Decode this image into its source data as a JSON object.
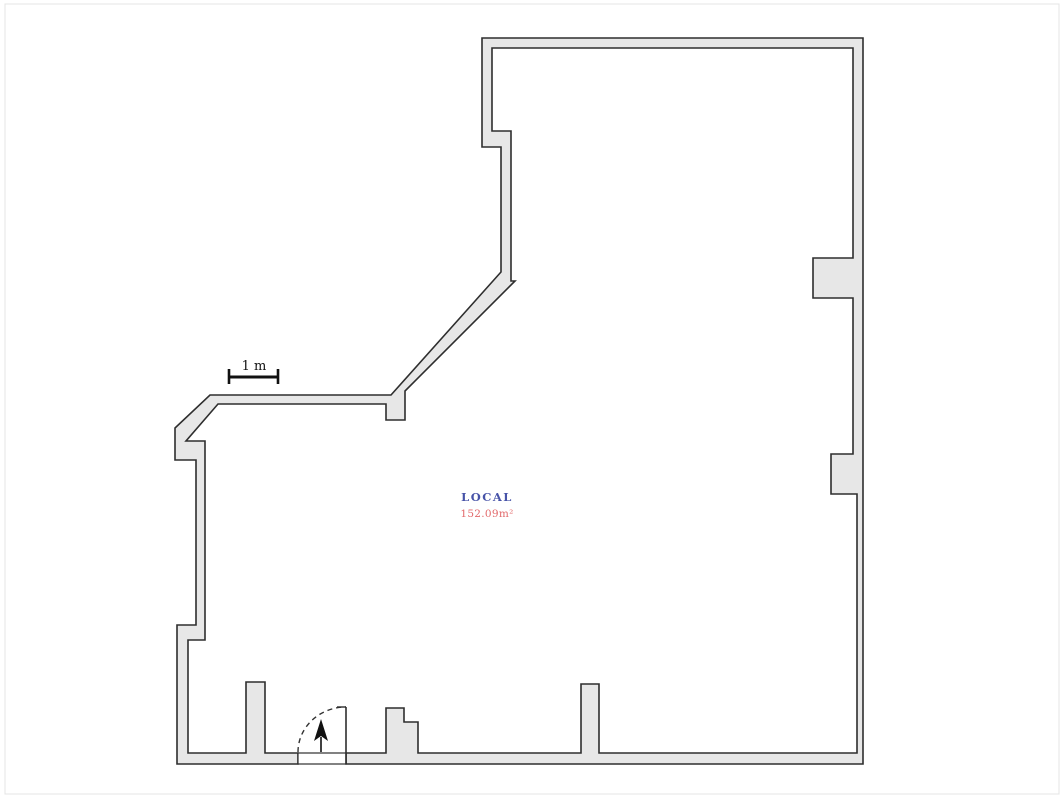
{
  "plan": {
    "canvas": {
      "width": 1064,
      "height": 798,
      "background": "#ffffff",
      "frame_color": "#e4e4e4"
    },
    "walls": {
      "fill": "#e7e7e7",
      "stroke": "#2e2e2e",
      "stroke_width": 1.6,
      "contour": [
        [
          482,
          38
        ],
        [
          863,
          38
        ],
        [
          863,
          764
        ],
        [
          346,
          764
        ],
        [
          346,
          753
        ],
        [
          386,
          753
        ],
        [
          386,
          708
        ],
        [
          404,
          708
        ],
        [
          404,
          722
        ],
        [
          418,
          722
        ],
        [
          418,
          753
        ],
        [
          581,
          753
        ],
        [
          581,
          684
        ],
        [
          599,
          684
        ],
        [
          599,
          753
        ],
        [
          857,
          753
        ],
        [
          857,
          494
        ],
        [
          831,
          494
        ],
        [
          831,
          454
        ],
        [
          853,
          454
        ],
        [
          853,
          298
        ],
        [
          813,
          298
        ],
        [
          813,
          258
        ],
        [
          853,
          258
        ],
        [
          853,
          48
        ],
        [
          492,
          48
        ],
        [
          492,
          131
        ],
        [
          511,
          131
        ],
        [
          511,
          281
        ],
        [
          515,
          281
        ],
        [
          405,
          391
        ],
        [
          405,
          420
        ],
        [
          386,
          420
        ],
        [
          386,
          404
        ],
        [
          218,
          404
        ],
        [
          186,
          441
        ],
        [
          205,
          441
        ],
        [
          205,
          640
        ],
        [
          188,
          640
        ],
        [
          188,
          753
        ],
        [
          246,
          753
        ],
        [
          246,
          682
        ],
        [
          265,
          682
        ],
        [
          265,
          753
        ],
        [
          298,
          753
        ],
        [
          298,
          764
        ],
        [
          177,
          764
        ],
        [
          177,
          625
        ],
        [
          196,
          625
        ],
        [
          196,
          460
        ],
        [
          175,
          460
        ],
        [
          175,
          428
        ],
        [
          210,
          395
        ],
        [
          391,
          395
        ],
        [
          501,
          272
        ],
        [
          501,
          147
        ],
        [
          482,
          147
        ]
      ]
    },
    "door": {
      "threshold": {
        "x": 298,
        "y": 753,
        "w": 48,
        "h": 11,
        "fill": "#ffffff",
        "stroke": "#2e2e2e",
        "stroke_width": 1.2
      },
      "leaf": {
        "x1": 346,
        "y1": 707,
        "x2": 346,
        "y2": 764,
        "stroke": "#2e2e2e",
        "stroke_width": 1.6
      },
      "leaf_tick": {
        "x1": 337,
        "y1": 707,
        "x2": 346,
        "y2": 707,
        "stroke": "#2e2e2e",
        "stroke_width": 1.4
      },
      "swing_arc": {
        "from_x": 298,
        "from_y": 752,
        "rx": 48,
        "ry": 45,
        "to_x": 346,
        "to_y": 707,
        "dash": "5,4",
        "stroke": "#333333",
        "stroke_width": 1.4
      },
      "entry_arrow": {
        "shaft": {
          "x1": 321,
          "y1": 752,
          "x2": 321,
          "y2": 737,
          "stroke": "#111111",
          "stroke_width": 1.6
        },
        "head_points": "321,719 328,741 321,736 314,741",
        "color": "#111111"
      }
    },
    "scale_bar": {
      "label": "1 m",
      "x1": 229,
      "x2": 278,
      "y": 377,
      "cap_top": 369,
      "cap_bottom": 384,
      "line_width": 3,
      "cap_width": 2.6,
      "color": "#111111",
      "label_x": 254,
      "label_y": 370,
      "font_size": 13
    },
    "room": {
      "name": "LOCAL",
      "area": "152.09m²",
      "name_color": "#4753a8",
      "area_color": "#e2696b",
      "x": 487,
      "name_y": 501,
      "area_y": 517,
      "name_size": 11.5,
      "area_size": 10.5
    }
  }
}
